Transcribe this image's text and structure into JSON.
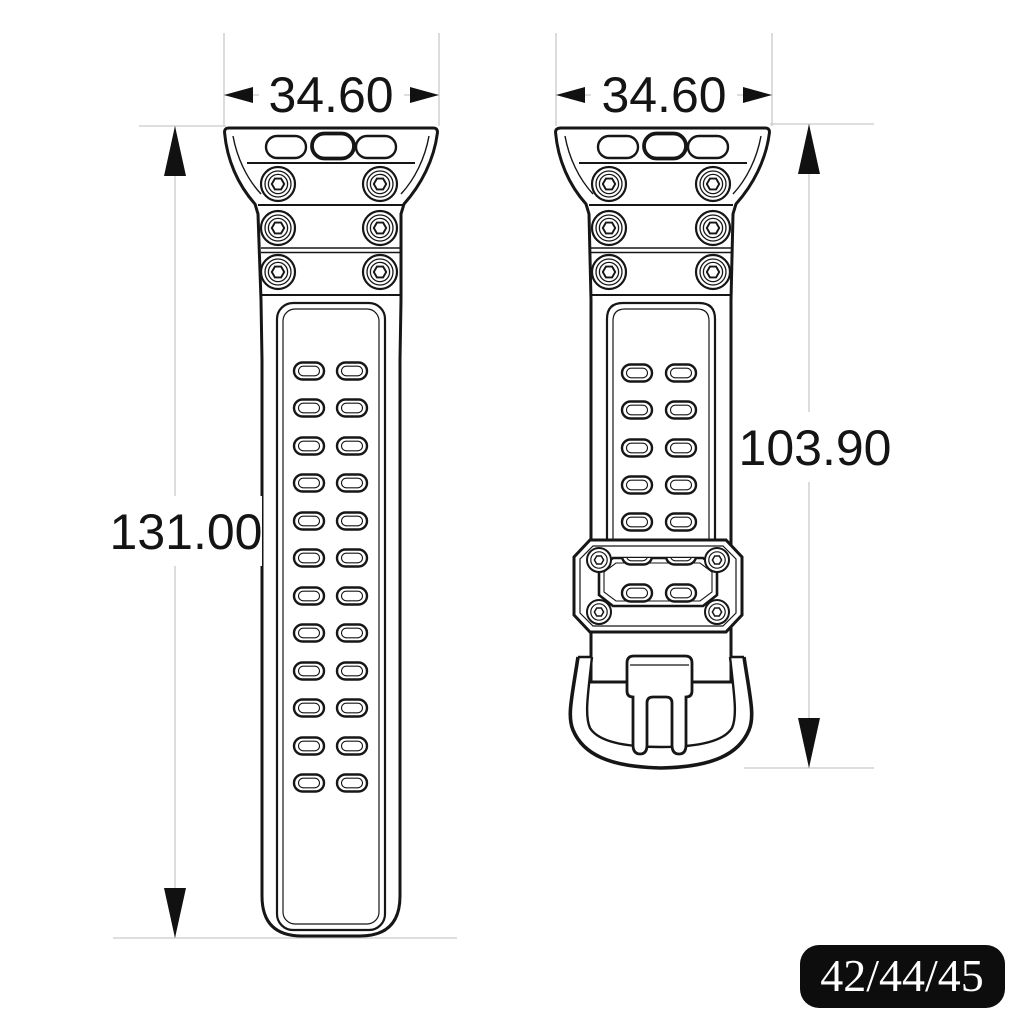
{
  "diagram": {
    "type": "technical-drawing",
    "subject": "two-piece watch strap dimensional drawing",
    "left_view": {
      "width_label": "34.60",
      "length_label": "131.00",
      "hole_rows": 12,
      "hole_cols": 2,
      "screw_rows": 3,
      "lug_slots": 3
    },
    "right_view": {
      "width_label": "34.60",
      "length_label": "103.90",
      "hole_rows": 5,
      "hole_cols": 2,
      "screw_rows": 3,
      "lug_slots": 3,
      "keeper_screws": 4
    },
    "badge": {
      "label": "42/44/45",
      "bg": "#0d0d0d",
      "fg": "#ffffff"
    },
    "colors": {
      "ink": "#161616",
      "dim_line": "#c9c9c9",
      "background": "#ffffff"
    }
  }
}
